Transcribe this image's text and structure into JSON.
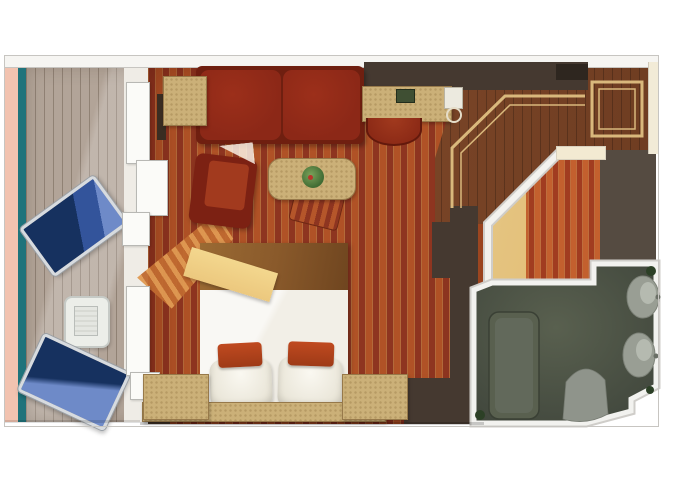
{
  "image": {
    "kind": "floor-plan",
    "subject": "Cruise ship balcony stateroom — top-down rendered floor plan",
    "visible_text": [],
    "width_px": 680,
    "height_px": 486
  },
  "palette": {
    "canvas": "#ffffff",
    "wall_light": "#f6f5f2",
    "wall_outline": "#c7c5c1",
    "wall_dark": "#453930",
    "wall_gray": "#554b41",
    "deck": "#b2a498",
    "accent_pink": "#f2c3b0",
    "accent_teal": "#1f737b",
    "carpet_base": "#8e3520",
    "carpet_stripe": "#b05226",
    "sofa": "#8c2817",
    "armchair": "#7c2113",
    "seat": "#a23a1e",
    "tan": "#cbb078",
    "tan_border": "#97794a",
    "wood": "#7a4527",
    "inlay": "#d9b87c",
    "bed_white": "#f2efe7",
    "blanket": "#8a5a2b",
    "throw": "#ecc87e",
    "pillow_orange": "#c04a20",
    "closet_glow": "#e3c07a",
    "bath_floor": "#4c5247",
    "fixture": "#989d93",
    "tub": "#59604f",
    "plant": "#2c4026",
    "plant_light": "#3f6b33",
    "chair_navy": "#16315f",
    "chair_blue": "#6e8ac8",
    "frame": "#d7dbdf",
    "glass": "#eceee9",
    "cream": "#f2ebd7"
  },
  "rooms": {
    "balcony": {
      "name": "Balcony",
      "floor": "wood deck planks",
      "items": [
        "lounge chair (upper)",
        "glass side table",
        "lounge chair (lower)"
      ]
    },
    "living_area": {
      "name": "Sitting area",
      "floor": "red striped carpet",
      "items": [
        "two-cushion sofa",
        "side table with lamp",
        "armchair",
        "oval table with plant",
        "striped pull-up chair",
        "desk with lamp and tv",
        "half-round desk stool"
      ]
    },
    "bedroom": {
      "name": "Bedroom",
      "items": [
        "double bed with brown blanket and gold throw",
        "orange accent pillow x2",
        "white pillow x2",
        "left nightstand with lamp",
        "right nightstand with lamp",
        "headboard wall"
      ]
    },
    "entry": {
      "name": "Entry hall",
      "floor": "wood parquet with tan inlay border"
    },
    "closet": {
      "name": "Closet",
      "items": [
        "hanging clothes (striped)",
        "lit interior"
      ]
    },
    "bathroom": {
      "name": "Bathroom",
      "floor": "dark speckled tile",
      "items": [
        "bathtub",
        "toilet",
        "round sink x2",
        "plants"
      ]
    }
  }
}
